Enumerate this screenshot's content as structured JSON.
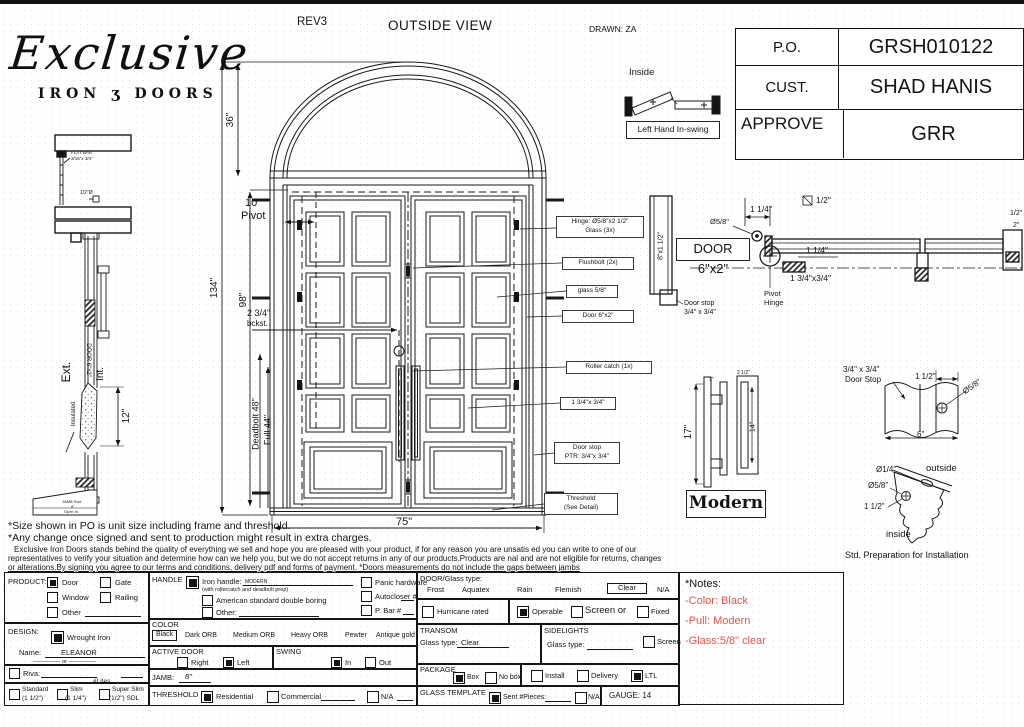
{
  "logo": {
    "script": "Exclusive",
    "word_left": "IRON",
    "scroll": "ʒ",
    "word_right": "DOORS"
  },
  "titlebar": {
    "rev": "REV3",
    "view": "OUTSIDE VIEW",
    "drawn": "DRAWN: ZA"
  },
  "order": {
    "rows": [
      {
        "label": "P.O.",
        "value": "GRSH010122"
      },
      {
        "label": "CUST.",
        "value": "SHAD HANIS"
      },
      {
        "label": "APPROVE",
        "value": "GRR"
      }
    ]
  },
  "swing_detail": {
    "inside": "Inside",
    "caption": "Left Hand In-swing"
  },
  "dims": {
    "d36": "36\"",
    "d134": "134\"",
    "d98": "98\"",
    "d10": "10\"",
    "pivot_word": "Pivot",
    "backset": "2 3/4\"",
    "bckst": "bckst.",
    "deadbolt": "Deadbolt 48\"",
    "pull": "Full 44\"",
    "width": "75\""
  },
  "callouts": {
    "hinge1": "Hinge: Ø5/8\"x2 1/2\"",
    "hinge2": "Glass (3x)",
    "flushbolt": "Flushbolt (2x)",
    "glass": "glass 5/8\"",
    "door": "Door 6\"x2\"",
    "roller": "Roller catch (1x)",
    "stile": "1 3/4\"x 3/4\"",
    "stop1": "Door stop",
    "stop2": "PTR: 3/4\"x 3/4\"",
    "thresh1": "Threshold",
    "thresh2": "(See Detail)"
  },
  "left_section": {
    "flatbar1": "FLAT BAR",
    "flatbar2": "3/16\"x 3/4\"",
    "halfdia": "1/2\"Ø",
    "ext": "Ext.",
    "int": "Int.",
    "door": "DOOR 6\"x2\"",
    "insulated": "Insulated",
    "d12": "12\"",
    "jamb1": "JAMB Size",
    "jamb2": "8\"",
    "jamb3": "Open in"
  },
  "plan_section": {
    "jamb": "8\"x1 1/2\"",
    "door": "DOOR 6\"x2\"",
    "dia": "Ø5/8\"",
    "d114a": "1 1/4\"",
    "sq": "1/2\"",
    "d114b": "1 1/4\"",
    "stopblk": "1 3/4\"x3/4\"",
    "pivot1": "Pivot",
    "pivot2": "Hinge",
    "dstop1": "Door stop",
    "dstop2": "3/4\" x 3/4\"",
    "edge1": "1/2\"",
    "edge2": "2\""
  },
  "pull_detail": {
    "d17": "17\"",
    "d14": "14\"",
    "d25": "2 1/2\"",
    "d1": "1\"",
    "caption": "Modern"
  },
  "stop_detail": {
    "t1": "3/4\" x 3/4\"",
    "t2": "Door Stop",
    "d112": "1 1/2\"",
    "dia": "Ø5/8\"",
    "d6": "6\""
  },
  "prep_detail": {
    "dia14": "Ø1/4\"",
    "dia58": "Ø5/8\"",
    "d112": "1 1/2\"",
    "outside": "outside",
    "inside": "inside",
    "caption": "Std. Preparation for Installation"
  },
  "disclaimer": {
    "l1": "*Size shown in PO is unit size including frame and threshold.",
    "l2": "*Any change once signed and sent to production might result in extra charges.",
    "p1": "Exclusive Iron Doors stands behind the quality of everything we sell and hope you are pleased with your product, if for any reason you are unsatis ed you can write to one of our",
    "p2": "representatives to verify your situation and determine how can we help you, but we do not accept returns in any of our products.Products are  nal and are not eligible for returns, changes",
    "p3": "or alterations.By signing you agree to our terms and conditions, delivery pdf and forms of payment. *Doors measurements do not include the gaps between jambs"
  },
  "form": {
    "product": {
      "label": "PRODUCT:",
      "door": "Door",
      "gate": "Gate",
      "window": "Window",
      "railing": "Railing",
      "other": "Other"
    },
    "handle": {
      "label": "HANDLE",
      "iron": "Iron handle:",
      "iron_value": "MODERN",
      "iron_note": "(with rollercatch and deadbolt prep)",
      "american": "American standard double boring",
      "other": "Other:",
      "panic": "Panic hardware",
      "autocloser": "Autocloser #",
      "pbar": "P. Bar #"
    },
    "color": {
      "label": "COLOR",
      "selected": "Black",
      "opts": [
        "Dark ORB",
        "Medium ORB",
        "Heavy ORB",
        "Pewter",
        "Antique gold"
      ]
    },
    "design": {
      "label": "DESIGN:",
      "wrought": "Wrought Iron",
      "name_label": "Name:",
      "name": "ELEANOR",
      "or": "—————  or  —————",
      "riva": "Riva:",
      "lites": "#Lites",
      "std": "Standard",
      "std2": "(1 1/2\")",
      "slim": "Slim",
      "slim2": "(1 1/4\")",
      "sslim": "Super Slim",
      "sslim2": "(1/2\") SDL"
    },
    "active": {
      "label": "ACTIVE DOOR",
      "right": "Right",
      "left": "Left"
    },
    "swing": {
      "label": "SWING",
      "in": "In",
      "out": "Out"
    },
    "jamb": {
      "label": "JAMB:",
      "value": "8\""
    },
    "threshold": {
      "label": "THRESHOLD",
      "res": "Residential",
      "com": "Commercial",
      "na": "N/A"
    },
    "doorglass": {
      "label": "DOOR/Glass type:",
      "frost": "Frost",
      "aquatex": "Aquatex",
      "rain": "Rain",
      "flemish": "Flemish",
      "clear": "Clear",
      "na": "N/A",
      "hurricane": "Hurricane rated",
      "operable": "Operable",
      "screen_or": "Screen or",
      "fixed": "Fixed"
    },
    "transom": {
      "label": "TRANSOM",
      "glass": "Glass type:",
      "value": "Clear"
    },
    "sidelights": {
      "label": "SIDELIGHTS",
      "glass": "Glass type:",
      "screen": "Screen"
    },
    "package": {
      "label": "PACKAGE",
      "box": "Box",
      "nobox": "No box",
      "install": "Install",
      "delivery": "Delivery",
      "ltl": "LTL"
    },
    "glasstemplate": {
      "label": "GLASS TEMPLATE",
      "sent": "Sent #Pieces:",
      "na": "N/A"
    },
    "gauge": "GAUGE: 14",
    "notes": {
      "title": "*Notes:",
      "n1": "-Color: Black",
      "n2": "-Pull: Modern",
      "n3": "-Glass:5/8\"  clear",
      "color": "#e2574e"
    }
  }
}
